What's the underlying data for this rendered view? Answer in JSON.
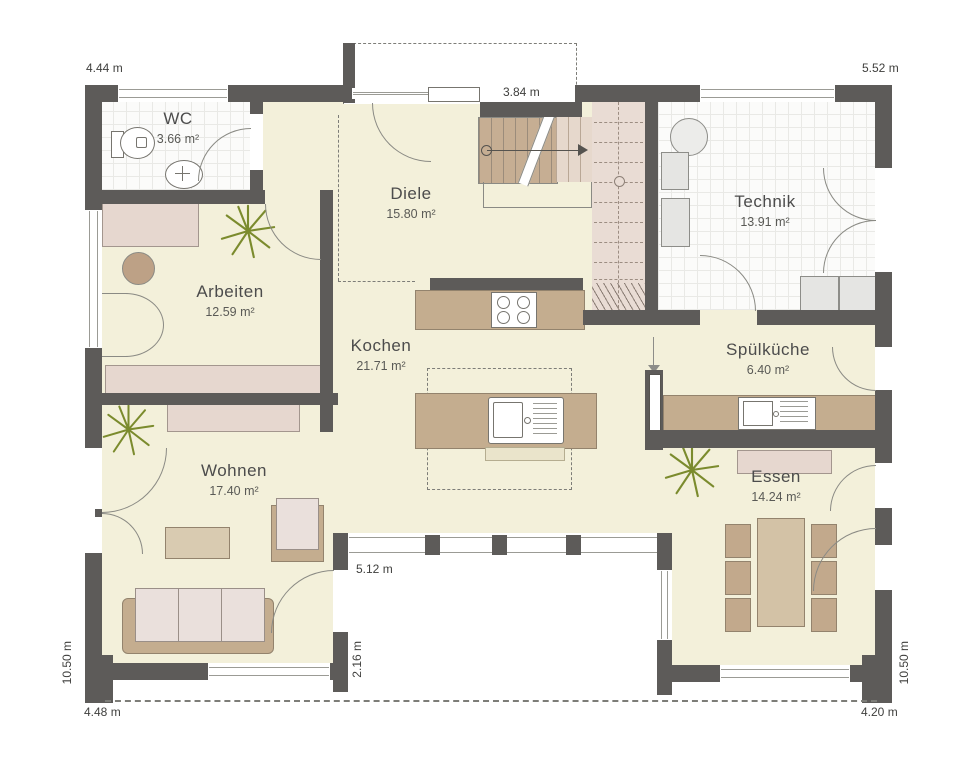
{
  "rooms": [
    {
      "key": "wc",
      "name": "WC",
      "area": "3.66 m²"
    },
    {
      "key": "diele",
      "name": "Diele",
      "area": "15.80 m²"
    },
    {
      "key": "technik",
      "name": "Technik",
      "area": "13.91 m²"
    },
    {
      "key": "arbeiten",
      "name": "Arbeiten",
      "area": "12.59 m²"
    },
    {
      "key": "kochen",
      "name": "Kochen",
      "area": "21.71 m²"
    },
    {
      "key": "spuelkueche",
      "name": "Spülküche",
      "area": "6.40 m²"
    },
    {
      "key": "wohnen",
      "name": "Wohnen",
      "area": "17.40 m²"
    },
    {
      "key": "essen",
      "name": "Essen",
      "area": "14.24 m²"
    }
  ],
  "dimensions": {
    "top_left": "4.44 m",
    "entrance_canopy": "3.84 m",
    "top_right": "5.52 m",
    "left_side": "10.50 m",
    "bottom_left": "4.48 m",
    "terrace_width": "5.12 m",
    "terrace_depth": "2.16 m",
    "bottom_right": "4.20 m",
    "right_side": "10.50 m"
  },
  "icons": [
    "plant-icon",
    "stair-direction-arrow-icon",
    "radiator-icon",
    "sink-icon",
    "stove-icon",
    "toilet-icon",
    "washbasin-icon",
    "boiler-icon"
  ],
  "colors": {
    "wall": "#5d5b59",
    "floor": "#f3f0da",
    "wood": "#c4ad8f",
    "sideboard": "#e6d7cf",
    "stairs": "#e9dcd4",
    "cushion": "#eae0dc",
    "plant": "#7b8b2d",
    "line": "#8a8a84",
    "text": "#4c4c4c"
  }
}
